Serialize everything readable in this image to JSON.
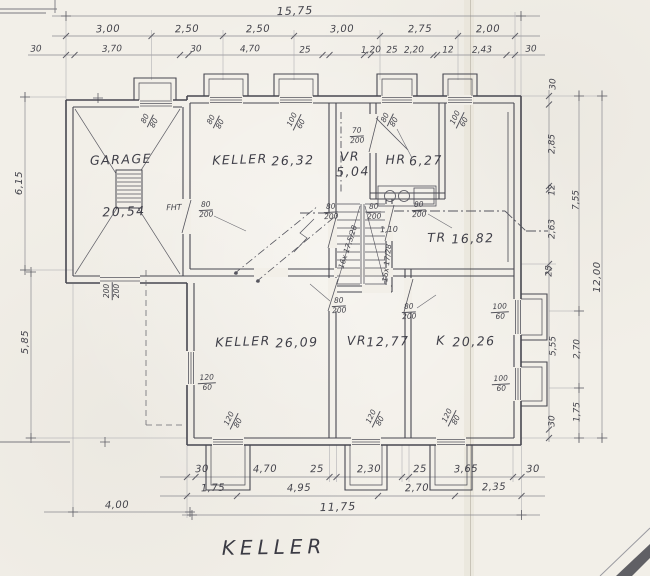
{
  "title": "KELLER",
  "rooms": {
    "garage": {
      "name": "GARAGE",
      "area": "20,54"
    },
    "keller_upper": {
      "name": "KELLER",
      "area": "26,32"
    },
    "vr_upper": {
      "name": "VR",
      "area": "5,04"
    },
    "hr": {
      "name": "HR",
      "area": "6,27"
    },
    "tr": {
      "name": "TR",
      "area": "16,82"
    },
    "keller_lower": {
      "name": "KELLER",
      "area": "26,09"
    },
    "vr_lower": {
      "name": "VR",
      "area": "12,77"
    },
    "k": {
      "name": "K",
      "area": "20,26"
    }
  },
  "dims": {
    "top_total": "15,75",
    "top_row2": [
      "3,00",
      "2,50",
      "2,50",
      "3,00",
      "2,75",
      "2,00"
    ],
    "top_row3": [
      "30",
      "3,70",
      "30",
      "4,70",
      "25",
      "1,20",
      "25",
      "2,20",
      "12",
      "2,43",
      "30"
    ],
    "bottom_row1": [
      "30",
      "4,70",
      "25",
      "2,30",
      "25",
      "3,65",
      "30"
    ],
    "bottom_row2": [
      "1,75",
      "4,95",
      "2,70",
      "2,35"
    ],
    "bottom_total": "11,75",
    "bottom_left": "4,00",
    "left": [
      "6,15",
      "5,85"
    ],
    "right_inner": [
      "30",
      "2,85",
      "12",
      "2,63",
      "25",
      "5,55",
      "30"
    ],
    "right_mid": [
      "7,55",
      "2,70",
      "1,75"
    ],
    "right_total": "12,00",
    "stair_width": "1,10"
  },
  "openings": {
    "fht_prefix": "FHT",
    "fht": {
      "num": "80",
      "den": "200"
    },
    "door_keller_vr": {
      "num": "80",
      "den": "200"
    },
    "door_stair": {
      "num": "80",
      "den": "200"
    },
    "door_tr": {
      "num": "80",
      "den": "200"
    },
    "door_hr": {
      "num": "70",
      "den": "200"
    },
    "door_vr_lower": {
      "num": "80",
      "den": "200"
    },
    "door_k": {
      "num": "80",
      "den": "200"
    },
    "garage_door": {
      "num": "200",
      "den": "200"
    },
    "win_garage": {
      "num": "80",
      "den": "80"
    },
    "win_keller_upper_left": {
      "num": "80",
      "den": "80"
    },
    "win_keller_upper_right": {
      "num": "100",
      "den": "60"
    },
    "win_hr": {
      "num": "80",
      "den": "80"
    },
    "win_tr": {
      "num": "100",
      "den": "60"
    },
    "win_keller_lower_side": {
      "num": "120",
      "den": "60"
    },
    "win_keller_lower": {
      "num": "120",
      "den": "80"
    },
    "win_vr_lower": {
      "num": "120",
      "den": "80"
    },
    "win_k_bottom": {
      "num": "120",
      "den": "80"
    },
    "win_k_right_upper": {
      "num": "100",
      "den": "60"
    },
    "win_k_right_lower": {
      "num": "100",
      "den": "60"
    }
  },
  "stairs": {
    "left_flight": "16x 17,5/28",
    "right_flight": "16x 17/28"
  },
  "colors": {
    "pencil": "#45454e",
    "paper": "#f2efe8"
  }
}
